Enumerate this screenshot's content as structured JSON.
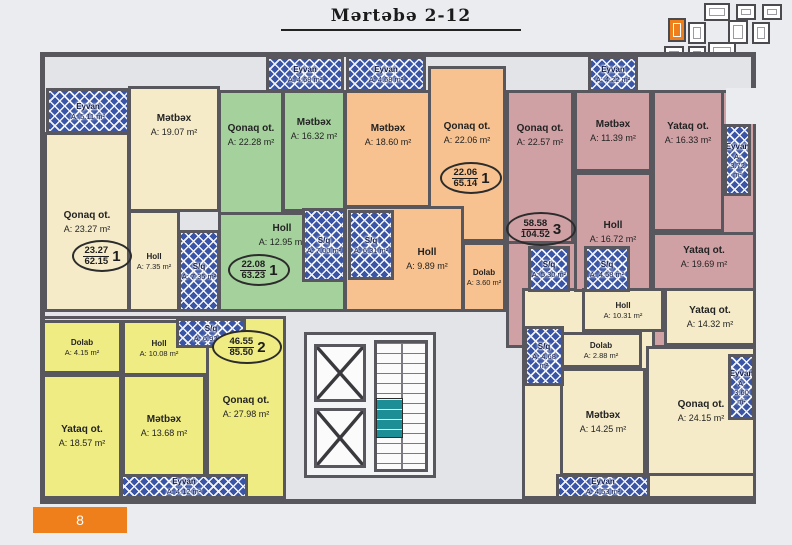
{
  "title": "Mərtəbə 2-12",
  "page_number": "8",
  "accent_color": "#ef7f1a",
  "hatch_color": "#3a55a6",
  "apartments": {
    "a1": {
      "color": "#f5ebc8",
      "badge": {
        "num": "23.27",
        "den": "62.15",
        "count": "1"
      },
      "rooms": {
        "eyvan": {
          "name": "Eyvan",
          "area": "A: 5.11 m²"
        },
        "metbex": {
          "name": "Mətbəx",
          "area": "A: 19.07 m²"
        },
        "qonaq": {
          "name": "Qonaq ot.",
          "area": "A: 23.27 m²"
        },
        "holl": {
          "name": "Holl",
          "area": "A: 7.35 m²"
        },
        "sq": {
          "name": "S/q",
          "area": "A: 7.35 m²"
        }
      }
    },
    "a2": {
      "color": "#a5d19d",
      "badge": {
        "num": "22.08",
        "den": "63.23",
        "count": "1"
      },
      "rooms": {
        "eyvan": {
          "name": "Eyvan",
          "area": "A: 4.68 m²"
        },
        "qonaq": {
          "name": "Qonaq ot.",
          "area": "A: 22.28 m²"
        },
        "metbex": {
          "name": "Mətbəx",
          "area": "A: 16.32 m²"
        },
        "holl": {
          "name": "Holl",
          "area": "A: 12.95 m²"
        },
        "sq": {
          "name": "S/q",
          "area": "A: 7.00 m²"
        }
      }
    },
    "a3": {
      "color": "#f7c28f",
      "badge": {
        "num": "22.06",
        "den": "65.14",
        "count": "1"
      },
      "rooms": {
        "eyvan": {
          "name": "Eyvan",
          "area": "A: 4.68 m²"
        },
        "metbex": {
          "name": "Mətbəx",
          "area": "A: 18.60 m²"
        },
        "qonaq": {
          "name": "Qonaq ot.",
          "area": "A: 22.06 m²"
        },
        "holl": {
          "name": "Holl",
          "area": "A: 9.89 m²"
        },
        "dolab": {
          "name": "Dolab",
          "area": "A: 3.60 m²"
        },
        "sq": {
          "name": "S/q",
          "area": "A: 6.31 m²"
        }
      }
    },
    "a4": {
      "color": "#cfa0a4",
      "badge": {
        "num": "58.58",
        "den": "104.52",
        "count": "3"
      },
      "rooms": {
        "eyvan_top": {
          "name": "Eyvan",
          "area": "A: 4.22 m²"
        },
        "qonaq": {
          "name": "Qonaq ot.",
          "area": "A: 22.57 m²"
        },
        "metbex": {
          "name": "Mətbəx",
          "area": "A: 11.39 m²"
        },
        "yataq1": {
          "name": "Yataq ot.",
          "area": "A: 16.33 m²"
        },
        "eyvan_right": {
          "name": "Eyvan",
          "area": "A: 3.72 m²"
        },
        "holl": {
          "name": "Holl",
          "area": "A: 16.72 m²"
        },
        "sq1": {
          "name": "S/q",
          "area": "A: 5.30 m²"
        },
        "sq2": {
          "name": "S/q",
          "area": "A: 4.58 m²"
        },
        "yataq2": {
          "name": "Yataq ot.",
          "area": "A: 19.69 m²"
        }
      }
    },
    "a5": {
      "color": "#f5ebc8",
      "rooms": {
        "holl": {
          "name": "Holl",
          "area": "A: 10.31 m²"
        },
        "yataq": {
          "name": "Yataq ot.",
          "area": "A: 14.32 m²"
        },
        "dolab": {
          "name": "Dolab",
          "area": "A: 2.88 m²"
        },
        "sq": {
          "name": "S/q",
          "area": "A: 4.68 m²"
        },
        "metbex": {
          "name": "Mətbəx",
          "area": "A: 14.25 m²"
        },
        "qonaq": {
          "name": "Qonaq ot.",
          "area": "A: 24.15 m²"
        },
        "eyvan_right": {
          "name": "Eyvan",
          "area": "A: 3.60 m²"
        },
        "eyvan_bottom": {
          "name": "Eyvan",
          "area": "A: 4.53 m²"
        }
      }
    },
    "a6": {
      "color": "#efec83",
      "badge": {
        "num": "46.55",
        "den": "85.50",
        "count": "2"
      },
      "rooms": {
        "dolab": {
          "name": "Dolab",
          "area": "A: 4.15 m²"
        },
        "holl": {
          "name": "Holl",
          "area": "A: 10.08 m²"
        },
        "sq": {
          "name": "S/q",
          "area": "A: 6.92 m²"
        },
        "yataq": {
          "name": "Yataq ot.",
          "area": "A: 18.57 m²"
        },
        "metbex": {
          "name": "Mətbəx",
          "area": "A: 13.68 m²"
        },
        "qonaq": {
          "name": "Qonaq ot.",
          "area": "A: 27.98 m²"
        },
        "eyvan": {
          "name": "Eyvan",
          "area": "A: 4.12 m²"
        }
      }
    }
  }
}
